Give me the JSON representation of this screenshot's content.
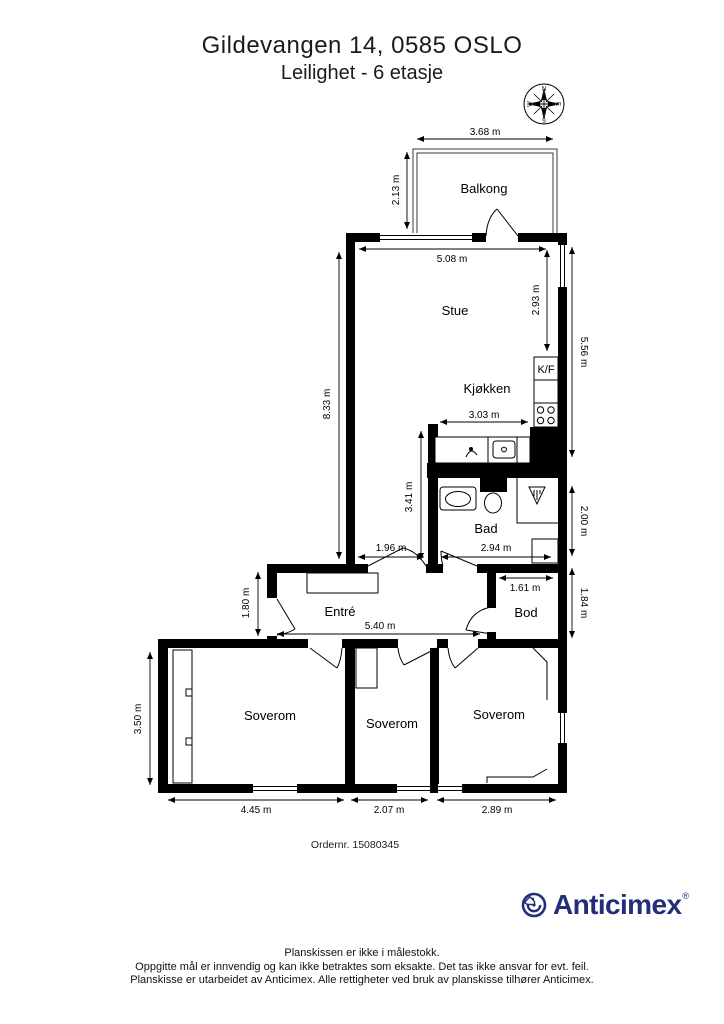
{
  "header": {
    "title": "Gildevangen 14, 0585 OSLO",
    "subtitle": "Leilighet - 6 etasje"
  },
  "compass": {
    "north": "N",
    "east": "E",
    "south": "S",
    "west": "W"
  },
  "rooms": {
    "balkong": "Balkong",
    "stue": "Stue",
    "kjokken": "Kjøkken",
    "kf": "K/F",
    "bad": "Bad",
    "entre": "Entré",
    "bod": "Bod",
    "soverom_left": "Soverom",
    "soverom_middle": "Soverom",
    "soverom_right": "Soverom"
  },
  "dimensions": {
    "balcony_width": "3.68 m",
    "balcony_depth": "2.13 m",
    "stue_width": "5.08 m",
    "stue_right_depth": "2.93 m",
    "west_side": "8.33 m",
    "east_side_upper": "5.56 m",
    "kitchen_width": "3.03 m",
    "hall_depth": "3.41 m",
    "passage_width": "1.96 m",
    "bath_width": "2.94 m",
    "bath_depth": "2.00 m",
    "bod_width": "1.61 m",
    "bod_depth": "1.84 m",
    "entre_depth": "1.80 m",
    "entre_width": "5.40 m",
    "bedroom_west_depth": "3.50 m",
    "bedroom_left_width": "4.45 m",
    "bedroom_middle_width": "2.07 m",
    "bedroom_right_width": "2.89 m"
  },
  "order_number": "Ordernr. 15080345",
  "logo": {
    "brand": "Anticimex",
    "registered": "®",
    "color": "#232d78"
  },
  "footer": {
    "line1": "Planskissen er ikke i målestokk.",
    "line2": "Oppgitte mål er innvendig og kan ikke betraktes som eksakte. Det tas ikke ansvar for evt. feil.",
    "line3": "Planskisse er utarbeidet av Anticimex. Alle rettigheter ved bruk av planskisse tilhører Anticimex."
  }
}
